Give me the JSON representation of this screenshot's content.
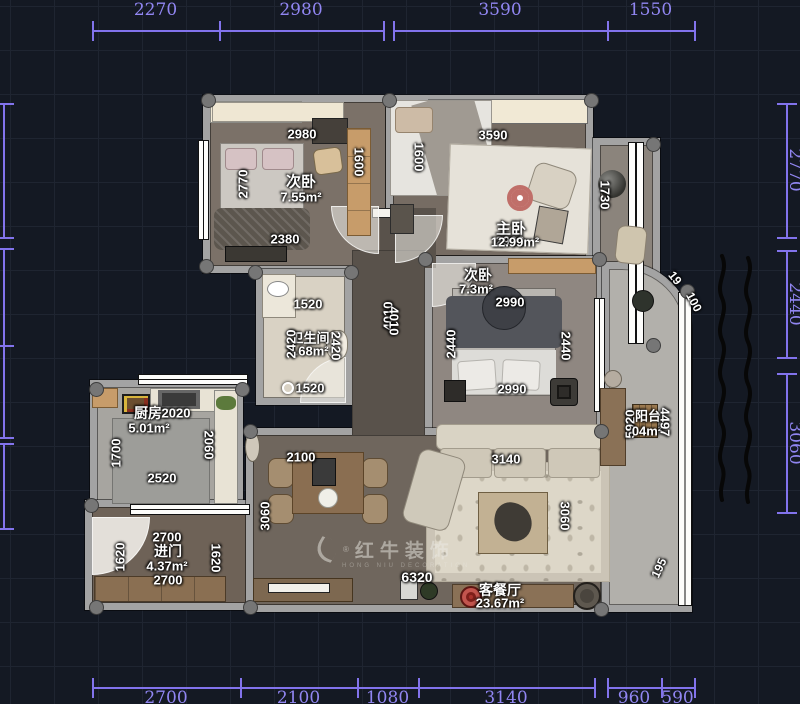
{
  "canvas": {
    "bg": "#141923",
    "grid": "#1f2531",
    "dim_color": "#8273ec",
    "wall_color": "#a3a3a3",
    "label_color": "#ffffff"
  },
  "watermark": {
    "brand": "红牛装饰",
    "sub": "HONG NIU DECORATION",
    "registered": "®"
  },
  "dimensions": {
    "top": {
      "y": 30,
      "chains": [
        {
          "ticks": [
            92,
            219,
            383
          ],
          "labels": [
            "2270",
            "2980"
          ]
        },
        {
          "ticks": [
            393,
            607,
            694
          ],
          "labels": [
            "3590",
            "1550"
          ]
        }
      ]
    },
    "bottom": {
      "y": 687,
      "chains": [
        {
          "ticks": [
            92,
            240,
            357,
            418,
            594
          ],
          "labels": [
            "2700",
            "2100",
            "1080",
            "3140"
          ]
        },
        {
          "ticks": [
            607,
            661,
            694
          ],
          "labels": [
            "960",
            "590"
          ]
        }
      ]
    },
    "right": {
      "x": 786,
      "chains": [
        {
          "ticks": [
            103,
            237
          ],
          "labels": [
            "2770"
          ]
        },
        {
          "ticks": [
            250,
            357
          ],
          "labels": [
            "2440"
          ]
        },
        {
          "ticks": [
            373,
            512
          ],
          "labels": [
            "3060"
          ]
        }
      ]
    },
    "left": {
      "x": 3,
      "chains": [
        {
          "ticks": [
            103,
            237
          ],
          "labels": [
            ""
          ]
        },
        {
          "ticks": [
            248,
            345
          ],
          "labels": [
            ""
          ]
        },
        {
          "ticks": [
            345,
            437
          ],
          "labels": [
            ""
          ]
        },
        {
          "ticks": [
            443,
            528
          ],
          "labels": [
            ""
          ]
        }
      ]
    }
  },
  "plan_labels": [
    {
      "text": "次卧",
      "x": 301,
      "y": 181,
      "rot": 0,
      "size": 15
    },
    {
      "text": "7.55m²",
      "x": 301,
      "y": 197,
      "rot": 0,
      "size": 13
    },
    {
      "text": "2980",
      "x": 302,
      "y": 134,
      "rot": 0,
      "size": 13
    },
    {
      "text": "2770",
      "x": 243,
      "y": 184,
      "rot": -90,
      "size": 13
    },
    {
      "text": "1600",
      "x": 359,
      "y": 162,
      "rot": 90,
      "size": 13
    },
    {
      "text": "2380",
      "x": 285,
      "y": 239,
      "rot": 0,
      "size": 13
    },
    {
      "text": "3590",
      "x": 493,
      "y": 135,
      "rot": 0,
      "size": 13
    },
    {
      "text": "1600",
      "x": 419,
      "y": 157,
      "rot": 90,
      "size": 13
    },
    {
      "text": "主卧",
      "x": 511,
      "y": 228,
      "rot": 0,
      "size": 15
    },
    {
      "text": "2990",
      "x": 510,
      "y": 241,
      "rot": 0,
      "size": 13
    },
    {
      "text": "12.99m²",
      "x": 515,
      "y": 242,
      "rot": 0,
      "size": 13
    },
    {
      "text": "1730",
      "x": 605,
      "y": 195,
      "rot": 90,
      "size": 13
    },
    {
      "text": "次卧",
      "x": 478,
      "y": 275,
      "rot": 0,
      "size": 14
    },
    {
      "text": "7.3m²",
      "x": 476,
      "y": 289,
      "rot": 0,
      "size": 13
    },
    {
      "text": "2990",
      "x": 510,
      "y": 302,
      "rot": 0,
      "size": 13
    },
    {
      "text": "2440",
      "x": 451,
      "y": 344,
      "rot": -90,
      "size": 13
    },
    {
      "text": "2440",
      "x": 566,
      "y": 346,
      "rot": 90,
      "size": 13
    },
    {
      "text": "2990",
      "x": 512,
      "y": 389,
      "rot": 0,
      "size": 13
    },
    {
      "text": "1520",
      "x": 308,
      "y": 304,
      "rot": 0,
      "size": 13
    },
    {
      "text": "卫生间",
      "x": 310,
      "y": 337,
      "rot": 0,
      "size": 13
    },
    {
      "text": "3.68m²",
      "x": 308,
      "y": 351,
      "rot": 0,
      "size": 13
    },
    {
      "text": "2420",
      "x": 291,
      "y": 344,
      "rot": -90,
      "size": 13
    },
    {
      "text": "2420",
      "x": 336,
      "y": 346,
      "rot": 90,
      "size": 13
    },
    {
      "text": "1520",
      "x": 310,
      "y": 388,
      "rot": 0,
      "size": 13
    },
    {
      "text": "4010",
      "x": 388,
      "y": 316,
      "rot": -90,
      "size": 13
    },
    {
      "text": "4010",
      "x": 394,
      "y": 321,
      "rot": 90,
      "size": 13
    },
    {
      "text": "厨房",
      "x": 148,
      "y": 413,
      "rot": 0,
      "size": 14
    },
    {
      "text": "2020",
      "x": 176,
      "y": 413,
      "rot": 0,
      "size": 13
    },
    {
      "text": "5.01m²",
      "x": 149,
      "y": 428,
      "rot": 0,
      "size": 13
    },
    {
      "text": "1700",
      "x": 116,
      "y": 453,
      "rot": -90,
      "size": 13
    },
    {
      "text": "2060",
      "x": 209,
      "y": 445,
      "rot": 90,
      "size": 13
    },
    {
      "text": "2520",
      "x": 162,
      "y": 478,
      "rot": 0,
      "size": 13
    },
    {
      "text": "2700",
      "x": 167,
      "y": 537,
      "rot": 0,
      "size": 13
    },
    {
      "text": "进门",
      "x": 168,
      "y": 551,
      "rot": 0,
      "size": 14
    },
    {
      "text": "4.37m²",
      "x": 167,
      "y": 566,
      "rot": 0,
      "size": 13
    },
    {
      "text": "2700",
      "x": 168,
      "y": 580,
      "rot": 0,
      "size": 13
    },
    {
      "text": "1620",
      "x": 120,
      "y": 557,
      "rot": -90,
      "size": 13
    },
    {
      "text": "1620",
      "x": 216,
      "y": 558,
      "rot": 90,
      "size": 13
    },
    {
      "text": "2100",
      "x": 301,
      "y": 457,
      "rot": 0,
      "size": 13
    },
    {
      "text": "3060",
      "x": 265,
      "y": 516,
      "rot": -90,
      "size": 13
    },
    {
      "text": "3140",
      "x": 506,
      "y": 459,
      "rot": 0,
      "size": 13
    },
    {
      "text": "3060",
      "x": 565,
      "y": 516,
      "rot": 90,
      "size": 13
    },
    {
      "text": "6320",
      "x": 417,
      "y": 577,
      "rot": 0,
      "size": 14
    },
    {
      "text": "客餐厅",
      "x": 500,
      "y": 590,
      "rot": 0,
      "size": 14
    },
    {
      "text": "23.67m²",
      "x": 500,
      "y": 603,
      "rot": 0,
      "size": 13
    },
    {
      "text": "5920",
      "x": 630,
      "y": 424,
      "rot": -90,
      "size": 13
    },
    {
      "text": "阳台",
      "x": 648,
      "y": 415,
      "rot": 0,
      "size": 13
    },
    {
      "text": "04m²",
      "x": 647,
      "y": 431,
      "rot": 0,
      "size": 13
    },
    {
      "text": "4497",
      "x": 665,
      "y": 422,
      "rot": 90,
      "size": 13
    },
    {
      "text": "19",
      "x": 675,
      "y": 278,
      "rot": 52,
      "size": 12
    },
    {
      "text": "100",
      "x": 694,
      "y": 302,
      "rot": 62,
      "size": 12
    },
    {
      "text": "195",
      "x": 659,
      "y": 568,
      "rot": -65,
      "size": 12
    }
  ],
  "columns": [
    [
      207,
      99
    ],
    [
      388,
      99
    ],
    [
      590,
      99
    ],
    [
      652,
      143
    ],
    [
      205,
      265
    ],
    [
      254,
      271
    ],
    [
      350,
      271
    ],
    [
      424,
      258
    ],
    [
      598,
      258
    ],
    [
      652,
      344
    ],
    [
      95,
      388
    ],
    [
      241,
      388
    ],
    [
      90,
      504
    ],
    [
      249,
      430
    ],
    [
      600,
      430
    ],
    [
      249,
      606
    ],
    [
      600,
      608
    ],
    [
      686,
      290
    ],
    [
      95,
      606
    ]
  ],
  "rooms": [
    {
      "name": "bedroom-2-small",
      "label": "次卧",
      "area": "7.55m²"
    },
    {
      "name": "master-bedroom",
      "label": "主卧",
      "area": "12.99m²"
    },
    {
      "name": "bedroom-3-small",
      "label": "次卧",
      "area": "7.3m²"
    },
    {
      "name": "bathroom",
      "label": "卫生间",
      "area": "3.68m²"
    },
    {
      "name": "kitchen",
      "label": "厨房",
      "area": "5.01m²"
    },
    {
      "name": "entry",
      "label": "进门",
      "area": "4.37m²"
    },
    {
      "name": "living-dining",
      "label": "客餐厅",
      "area": "23.67m²"
    },
    {
      "name": "balcony",
      "label": "阳台",
      "area": "04m²"
    }
  ]
}
